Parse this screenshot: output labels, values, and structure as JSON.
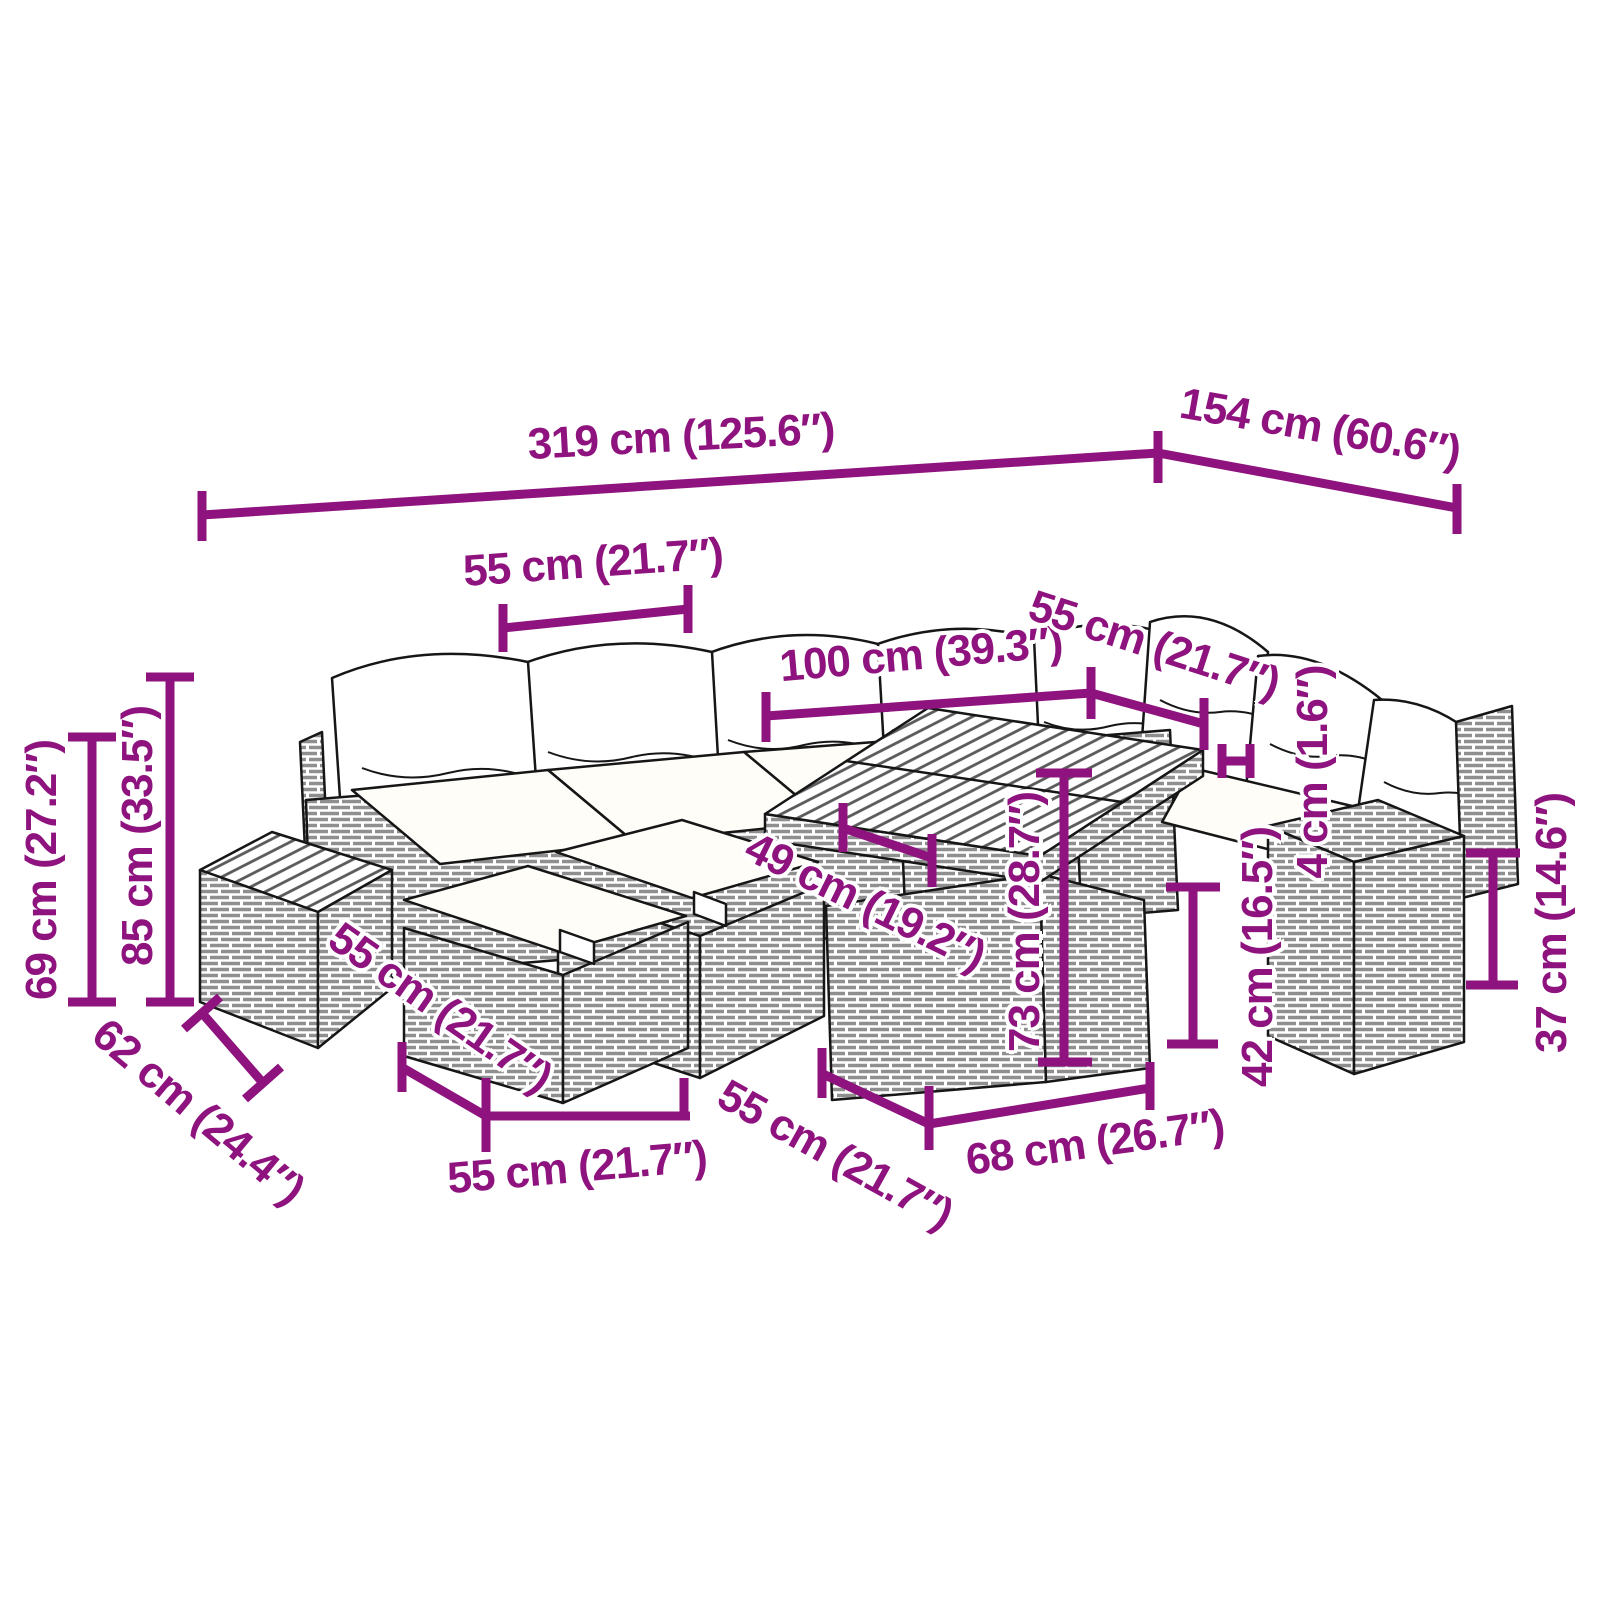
{
  "diagram": {
    "accent_color": "#8E137E",
    "line_art_color": "#161616",
    "labels": {
      "d319": "319 cm (125.6″)",
      "d154": "154 cm (60.6″)",
      "d55_top": "55 cm (21.7″)",
      "d100": "100 cm (39.3″)",
      "d55_right": "55 cm (21.7″)",
      "d4": "4 cm (1.6″)",
      "d85": "85 cm (33.5″)",
      "d69": "69 cm (27.2″)",
      "d49": "49 cm (19.2″)",
      "d73": "73 cm (28.7″)",
      "d55_ottoman": "55 cm (21.7″)",
      "d42": "42 cm (16.5″)",
      "d37": "37 cm (14.6″)",
      "d62": "62 cm (24.4″)",
      "d55_bottom": "55 cm (21.7″)",
      "d55_table": "55 cm (21.7″)",
      "d68": "68 cm (26.7″)"
    }
  }
}
